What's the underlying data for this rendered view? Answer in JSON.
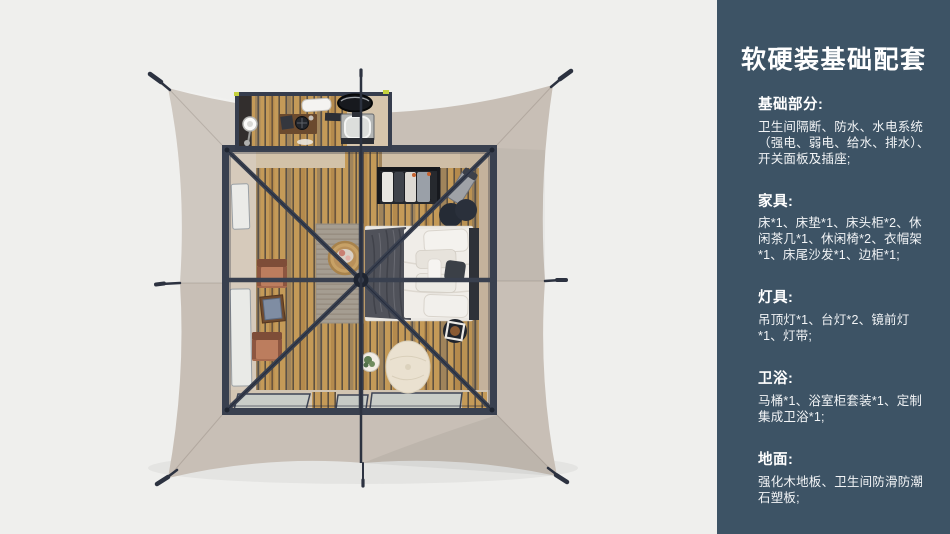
{
  "panel": {
    "title": "软硬装基础配套",
    "sections": [
      {
        "title": "基础部分:",
        "body": "卫生间隔断、防水、水电系统（强电、弱电、给水、排水）、开关面板及插座;"
      },
      {
        "title": "家具:",
        "body": "床*1、床垫*1、床头柜*2、休闲茶几*1、休闲椅*2、衣帽架*1、床尾沙发*1、边柜*1;"
      },
      {
        "title": "灯具:",
        "body": "吊顶灯*1、台灯*2、镜前灯*1、灯带;"
      },
      {
        "title": "卫浴:",
        "body": "马桶*1、浴室柜套装*1、定制集成卫浴*1;"
      },
      {
        "title": "地面:",
        "body": "强化木地板、卫生间防滑防潮石塑板;"
      }
    ]
  },
  "colors": {
    "page_bg": "#efefed",
    "panel_bg": "#3d5365",
    "panel_text": "#ffffff",
    "fabric": "#c8bfb6",
    "frame": "#39404f",
    "wood_plank": "#c49a58",
    "floor_beige": "#d5c7b1"
  }
}
